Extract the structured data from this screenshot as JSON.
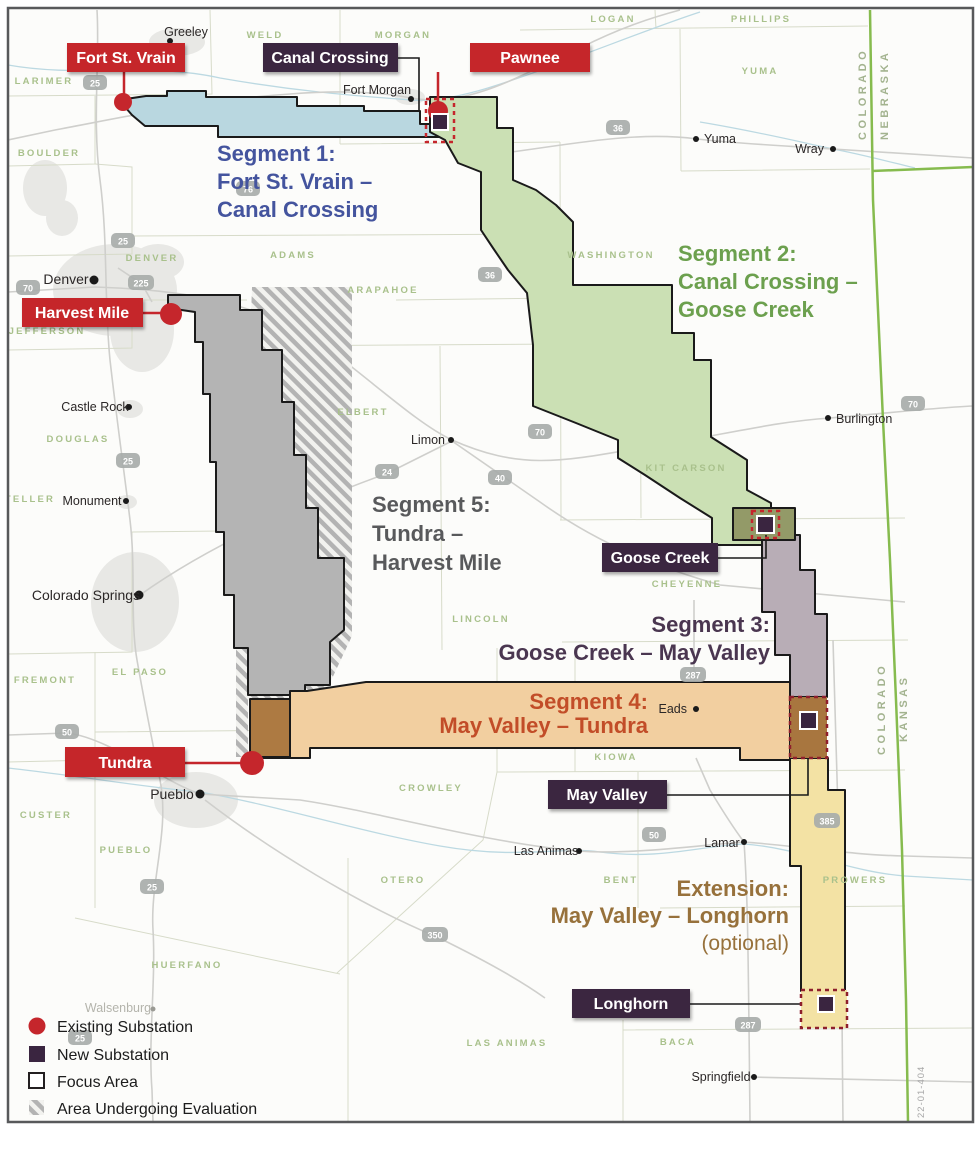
{
  "map_code": "22-01-404",
  "legend": {
    "existing": "Existing Substation",
    "new": "New Substation",
    "focus": "Focus Area",
    "evaluation": "Area Undergoing Evaluation"
  },
  "substation_labels": {
    "fort_st_vrain": "Fort St. Vrain",
    "canal_crossing": "Canal Crossing",
    "pawnee": "Pawnee",
    "harvest_mile": "Harvest Mile",
    "goose_creek": "Goose Creek",
    "tundra": "Tundra",
    "may_valley": "May Valley",
    "longhorn": "Longhorn"
  },
  "segments": {
    "s1": {
      "l1": "Segment 1:",
      "l2": "Fort St. Vrain –",
      "l3": "Canal Crossing",
      "text_color": "#44549e",
      "fill": "#b9d7e0"
    },
    "s2": {
      "l1": "Segment 2:",
      "l2": "Canal Crossing –",
      "l3": "Goose Creek",
      "text_color": "#6ca04e",
      "fill": "#cbe0b4"
    },
    "s3": {
      "l1": "Segment 3:",
      "l2": "Goose Creek – May Valley",
      "text_color": "#4a3650",
      "fill": "#b8adb6"
    },
    "s4": {
      "l1": "Segment 4:",
      "l2": "May Valley – Tundra",
      "text_color": "#c24d28",
      "fill": "#f2cfa0"
    },
    "s5": {
      "l1": "Segment 5:",
      "l2": "Tundra –",
      "l3": "Harvest Mile",
      "text_color": "#58595b",
      "fill": "#b4b4b4"
    },
    "ext": {
      "l1": "Extension:",
      "l2": "May Valley – Longhorn",
      "l3": "(optional)",
      "text_color": "#97713b",
      "fill": "#f3e2a4"
    }
  },
  "states": {
    "colorado": "COLORADO",
    "nebraska": "NEBRASKA",
    "kansas": "KANSAS"
  },
  "counties": {
    "larimer": "LARIMER",
    "weld": "WELD",
    "morgan": "MORGAN",
    "logan": "LOGAN",
    "phillips": "PHILLIPS",
    "yuma": "YUMA",
    "boulder": "BOULDER",
    "adams": "ADAMS",
    "denver": "DENVER",
    "arapahoe": "ARAPAHOE",
    "jefferson": "JEFFERSON",
    "washington": "WASHINGTON",
    "douglas": "DOUGLAS",
    "elbert": "ELBERT",
    "teller": "TELLER",
    "el_paso": "EL PASO",
    "fremont": "FREMONT",
    "lincoln": "LINCOLN",
    "kit_carson": "KIT CARSON",
    "cheyenne": "CHEYENNE",
    "custer": "CUSTER",
    "pueblo": "PUEBLO",
    "crowley": "CROWLEY",
    "kiowa": "KIOWA",
    "otero": "OTERO",
    "bent": "BENT",
    "prowers": "PROWERS",
    "huerfano": "HUERFANO",
    "las_animas": "LAS ANIMAS",
    "baca": "BACA"
  },
  "cities": {
    "greeley": "Greeley",
    "fort_morgan": "Fort Morgan",
    "yuma": "Yuma",
    "wray": "Wray",
    "denver": "Denver",
    "castle_rock": "Castle Rock",
    "monument": "Monument",
    "colorado_springs": "Colorado Springs",
    "limon": "Limon",
    "burlington": "Burlington",
    "eads": "Eads",
    "pueblo": "Pueblo",
    "las_animas": "Las Animas",
    "lamar": "Lamar",
    "walsenburg": "Walsenburg",
    "springfield": "Springfield"
  },
  "highways": {
    "i25": "25",
    "i76": "76",
    "i70": "70",
    "i225": "225",
    "us24": "24",
    "us36": "36",
    "us40": "40",
    "us50": "50",
    "us287": "287",
    "us350": "350",
    "us385": "385"
  },
  "colors": {
    "existing_substation": "#c5262c",
    "new_substation": "#3a2540",
    "state_border_green": "#86bb4e",
    "focus_dash_red": "#c5262c",
    "focus_dash_maroon": "#8e1f2c"
  }
}
